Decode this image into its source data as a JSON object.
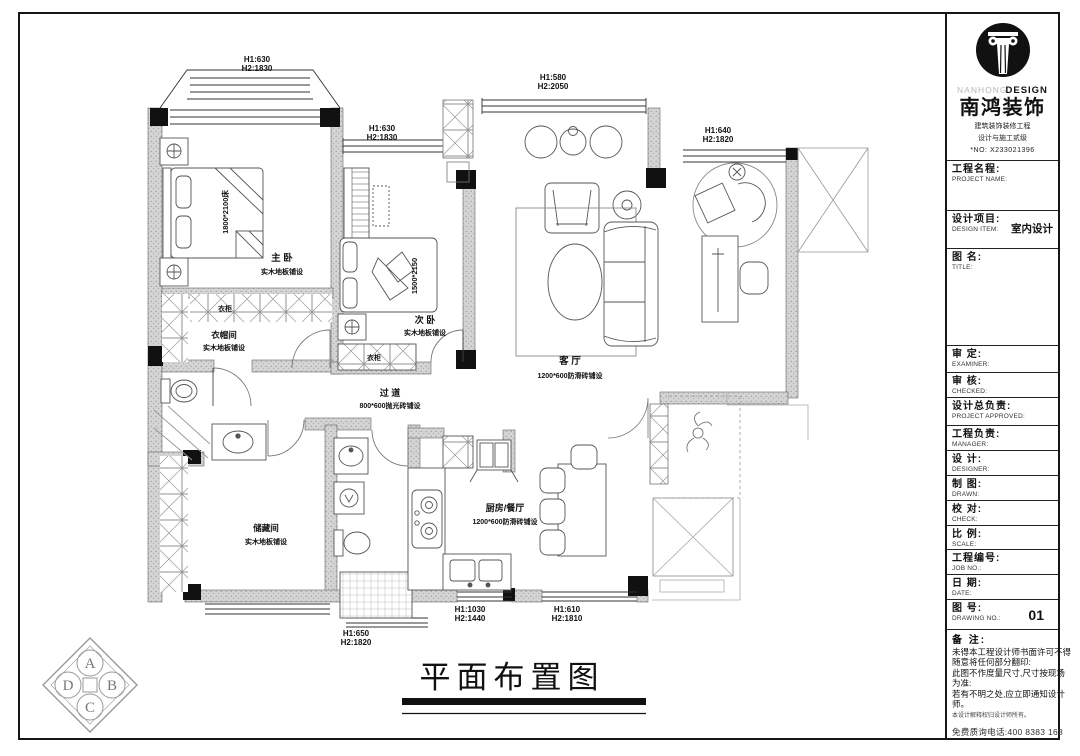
{
  "title_block": {
    "brand": {
      "en_light": "NANHONG",
      "en_bold": "DESIGN",
      "cn": "南鸿装饰",
      "sub1": "建筑装饰装修工程",
      "sub2": "设计与施工贰级",
      "no": "*NO: X233021396"
    },
    "fields": [
      {
        "cn": "工程名程:",
        "en": "PROJECT NAME:",
        "value": ""
      },
      {
        "cn": "设计项目:",
        "en": "DESIGN ITEM:",
        "value": "室内设计"
      },
      {
        "cn": "图  名:",
        "en": "TITLE:",
        "value": ""
      },
      {
        "cn": "审  定:",
        "en": "EXAMINER:",
        "value": ""
      },
      {
        "cn": "审  核:",
        "en": "CHECKED:",
        "value": ""
      },
      {
        "cn": "设计总负责:",
        "en": "PROJECT APPROVED:",
        "value": ""
      },
      {
        "cn": "工程负责:",
        "en": "MANAGER:",
        "value": ""
      },
      {
        "cn": "设  计:",
        "en": "DESIGNER:",
        "value": ""
      },
      {
        "cn": "制  图:",
        "en": "DRAWN:",
        "value": ""
      },
      {
        "cn": "校  对:",
        "en": "CHECK:",
        "value": ""
      },
      {
        "cn": "比  例:",
        "en": "SCALE:",
        "value": ""
      },
      {
        "cn": "工程编号:",
        "en": "JOB NO.:",
        "value": ""
      },
      {
        "cn": "日  期:",
        "en": "DATE:",
        "value": ""
      },
      {
        "cn": "图  号:",
        "en": "DRAWING NO.:",
        "value": "01"
      }
    ],
    "notes": {
      "label": "备 注:",
      "line1": "未得本工程设计师书面许可不得",
      "line2": "随意将任何部分翻印:",
      "line3": "此图不作度量尺寸,尺寸按现场",
      "line4": "为准:",
      "line5": "若有不明之处,应立即通知设计",
      "line6": "师。",
      "fine": "本设计解释权归设计师所有。",
      "phone": "免费质询电话:400 8383 168"
    }
  },
  "plan": {
    "drawing_title": "平面布置图",
    "dims": [
      {
        "l1": "H1:630",
        "l2": "H2:1830"
      },
      {
        "l1": "H1:630",
        "l2": "H2:1830"
      },
      {
        "l1": "H1:580",
        "l2": "H2:2050"
      },
      {
        "l1": "H1:640",
        "l2": "H2:1820"
      },
      {
        "l1": "H1:650",
        "l2": "H2:1820"
      },
      {
        "l1": "H1:1030",
        "l2": "H2:1440"
      },
      {
        "l1": "H1:610",
        "l2": "H2:1810"
      }
    ],
    "rooms": [
      {
        "name": "主  卧",
        "floor": "实木地板铺设"
      },
      {
        "name": "衣帽间",
        "floor": "实木地板铺设"
      },
      {
        "name": "次  卧",
        "floor": "实木地板铺设"
      },
      {
        "name": "过  道",
        "floor": "800*600抛光砖铺设"
      },
      {
        "name": "客  厅",
        "floor": "1200*600防滑砖铺设"
      },
      {
        "name": "厨房/餐厅",
        "floor": "1200*600防滑砖铺设"
      },
      {
        "name": "储藏间",
        "floor": "实木地板铺设"
      }
    ],
    "furniture_labels": {
      "bed_master": "1800*2100床",
      "bed_second": "1500*2150",
      "wardrobe1": "衣柜",
      "wardrobe2": "衣柜"
    },
    "compass": {
      "a": "A",
      "b": "B",
      "c": "C",
      "d": "D"
    }
  }
}
